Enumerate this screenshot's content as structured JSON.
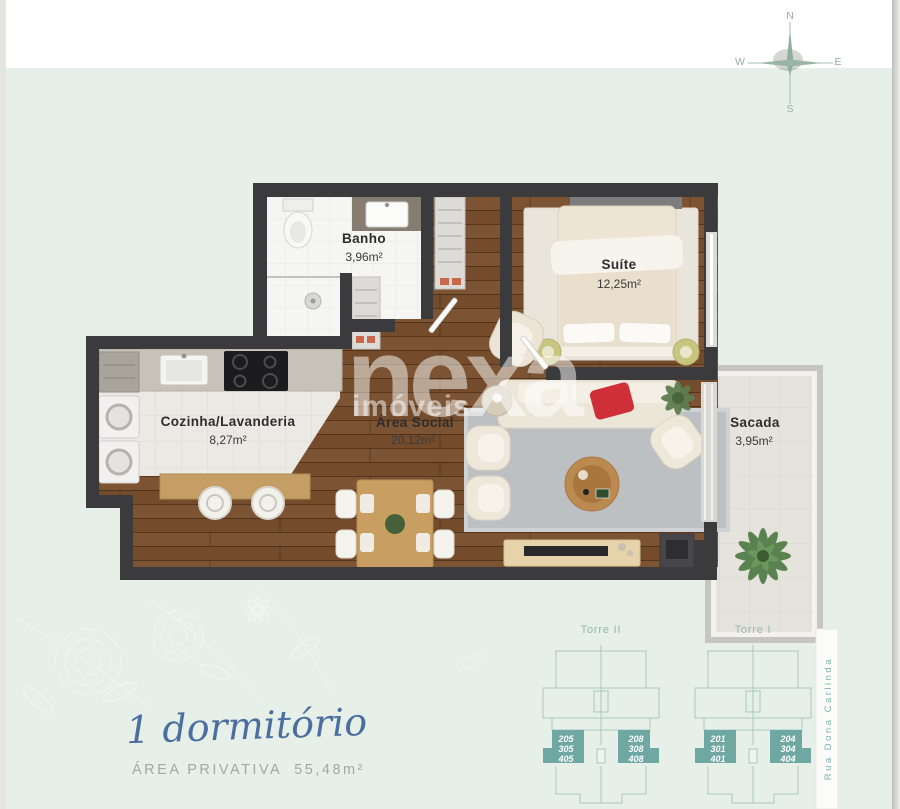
{
  "compass": {
    "n": "N",
    "e": "E",
    "s": "S",
    "w": "W"
  },
  "watermark": {
    "brand": "nexa",
    "suffix": "imóveis"
  },
  "plan": {
    "rooms": [
      {
        "name": "Banho",
        "area": "3,96m²"
      },
      {
        "name": "Suíte",
        "area": "12,25m²"
      },
      {
        "name": "Cozinha/Lavanderia",
        "area": "8,27m²"
      },
      {
        "name": "Área Social",
        "area": "20,12m²"
      },
      {
        "name": "Sacada",
        "area": "3,95m²"
      }
    ]
  },
  "summary": {
    "title": "1 dormitório",
    "area_label": "ÁREA PRIVATIVA",
    "area_value": "55,48m²"
  },
  "towers": [
    {
      "name": "Torre II",
      "left_units": [
        "205",
        "305",
        "405"
      ],
      "right_units": [
        "208",
        "308",
        "408"
      ]
    },
    {
      "name": "Torre I",
      "left_units": [
        "201",
        "301",
        "401"
      ],
      "right_units": [
        "204",
        "304",
        "404"
      ]
    }
  ],
  "street": {
    "name": "Rua Dona Carlinda"
  },
  "colors": {
    "background": "#e7f0e8",
    "wall": "#3b3b3d",
    "accent_teal": "#6fa8a2",
    "tower_outline": "#a5c8c1",
    "title_blue": "#4c6da0",
    "red_pillow": "#cf2f38"
  }
}
